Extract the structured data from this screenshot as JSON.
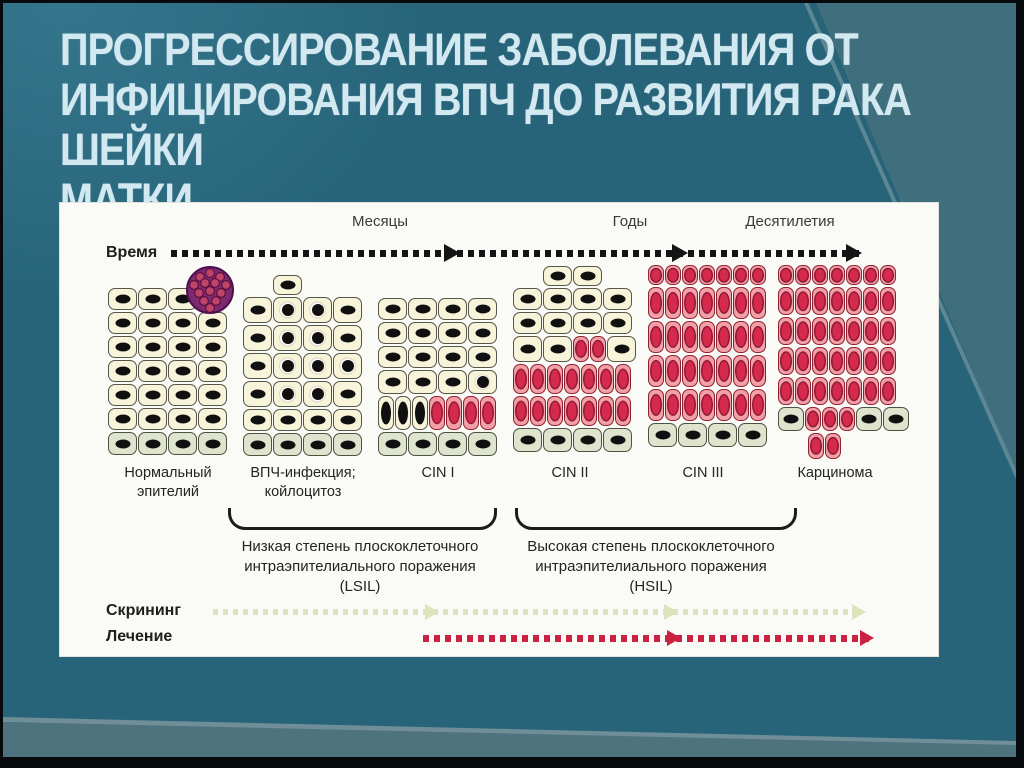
{
  "slide": {
    "title_lines": [
      "ПРОГРЕССИРОВАНИЕ ЗАБОЛЕВАНИЯ ОТ",
      "ИНФИЦИРОВАНИЯ ВПЧ ДО РАЗВИТИЯ РАКА ШЕЙКИ",
      "МАТКИ."
    ]
  },
  "figure": {
    "time_axis": {
      "label": "Время",
      "units": [
        "Месяцы",
        "Годы",
        "Десятилетия"
      ]
    },
    "stages": [
      {
        "l1": "Нормальный",
        "l2": "эпителий"
      },
      {
        "l1": "ВПЧ-инфекция;",
        "l2": "койлоцитоз"
      },
      {
        "l1": "CIN I"
      },
      {
        "l1": "CIN II"
      },
      {
        "l1": "CIN III"
      },
      {
        "l1": "Карцинома"
      }
    ],
    "grades": [
      {
        "l1": "Низкая степень плоскоклеточного",
        "l2": "интраэпителиального поражения",
        "l3": "(LSIL)"
      },
      {
        "l1": "Высокая степень плоскоклеточного",
        "l2": "интраэпителиального поражения",
        "l3": "(HSIL)"
      }
    ],
    "screening_label": "Скрининг",
    "treatment_label": "Лечение",
    "colors": {
      "slide_bg": "#276479",
      "title_text": "#d3e9f2",
      "cell_cream": "#f7f4d9",
      "cell_basal": "#dfe4ce",
      "cell_pink": "#f2a0a7",
      "nucleus_pink": "#d52a4c",
      "virus_purple": "#7d2a6e",
      "time_dots": "#141414",
      "screening_dots": "#dde3bd",
      "treatment_dots": "#cb2243"
    },
    "blocks": [
      {
        "name": "normal-epithelium",
        "left": 48,
        "top": 85,
        "rows": [
          {
            "h": 22,
            "cells": "nnnn"
          },
          {
            "h": 22,
            "cells": "nnnn"
          },
          {
            "h": 22,
            "cells": "nnnn"
          },
          {
            "h": 22,
            "cells": "nnnn"
          },
          {
            "h": 22,
            "cells": "nnnn"
          },
          {
            "h": 22,
            "cells": "nnnn"
          },
          {
            "h": 23,
            "cells": "bbbb"
          }
        ]
      },
      {
        "name": "hpv-koilocytosis",
        "left": 183,
        "top": 72,
        "rows": [
          {
            "h": 20,
            "cells": "sn"
          },
          {
            "h": 26,
            "cells": "nkkn"
          },
          {
            "h": 26,
            "cells": "nkkn"
          },
          {
            "h": 26,
            "cells": "nkkk"
          },
          {
            "h": 26,
            "cells": "nkkn"
          },
          {
            "h": 22,
            "cells": "nnnn"
          },
          {
            "h": 23,
            "cells": "bbbb"
          }
        ]
      },
      {
        "name": "cin-1",
        "left": 318,
        "top": 95,
        "rows": [
          {
            "h": 22,
            "cells": "nnnn"
          },
          {
            "h": 22,
            "cells": "nnnn"
          },
          {
            "h": 22,
            "cells": "nnnn"
          },
          {
            "h": 24,
            "cells": "nnnk"
          },
          {
            "h": 34,
            "cells": "dddpppp"
          },
          {
            "h": 24,
            "cells": "bbbb"
          }
        ]
      },
      {
        "name": "cin-2",
        "left": 453,
        "top": 63,
        "rows": [
          {
            "h": 20,
            "cells": "snn"
          },
          {
            "h": 22,
            "cells": "nnnn"
          },
          {
            "h": 22,
            "cells": "nnnn"
          },
          {
            "h": 26,
            "cells": "nnppn"
          },
          {
            "h": 30,
            "cells": "ppppppp"
          },
          {
            "h": 30,
            "cells": "ppppppp"
          },
          {
            "h": 24,
            "cells": "bbbb"
          }
        ]
      },
      {
        "name": "cin-3",
        "left": 588,
        "top": 62,
        "rows": [
          {
            "h": 20,
            "cells": "ppppppp"
          },
          {
            "h": 32,
            "cells": "ppppppp"
          },
          {
            "h": 32,
            "cells": "ppppppp"
          },
          {
            "h": 32,
            "cells": "ppppppp"
          },
          {
            "h": 32,
            "cells": "ppppppp"
          },
          {
            "h": 24,
            "cells": "bbbb"
          }
        ]
      },
      {
        "name": "carcinoma",
        "left": 718,
        "top": 62,
        "rows": [
          {
            "h": 20,
            "cells": "ppppppp"
          },
          {
            "h": 28,
            "cells": "ppppppp"
          },
          {
            "h": 28,
            "cells": "ppppppp"
          },
          {
            "h": 28,
            "cells": "ppppppp"
          },
          {
            "h": 28,
            "cells": "ppppppp"
          },
          {
            "h": 24,
            "cells": "BpppBB"
          },
          {
            "h": 26,
            "cells": "spp"
          }
        ]
      }
    ]
  }
}
